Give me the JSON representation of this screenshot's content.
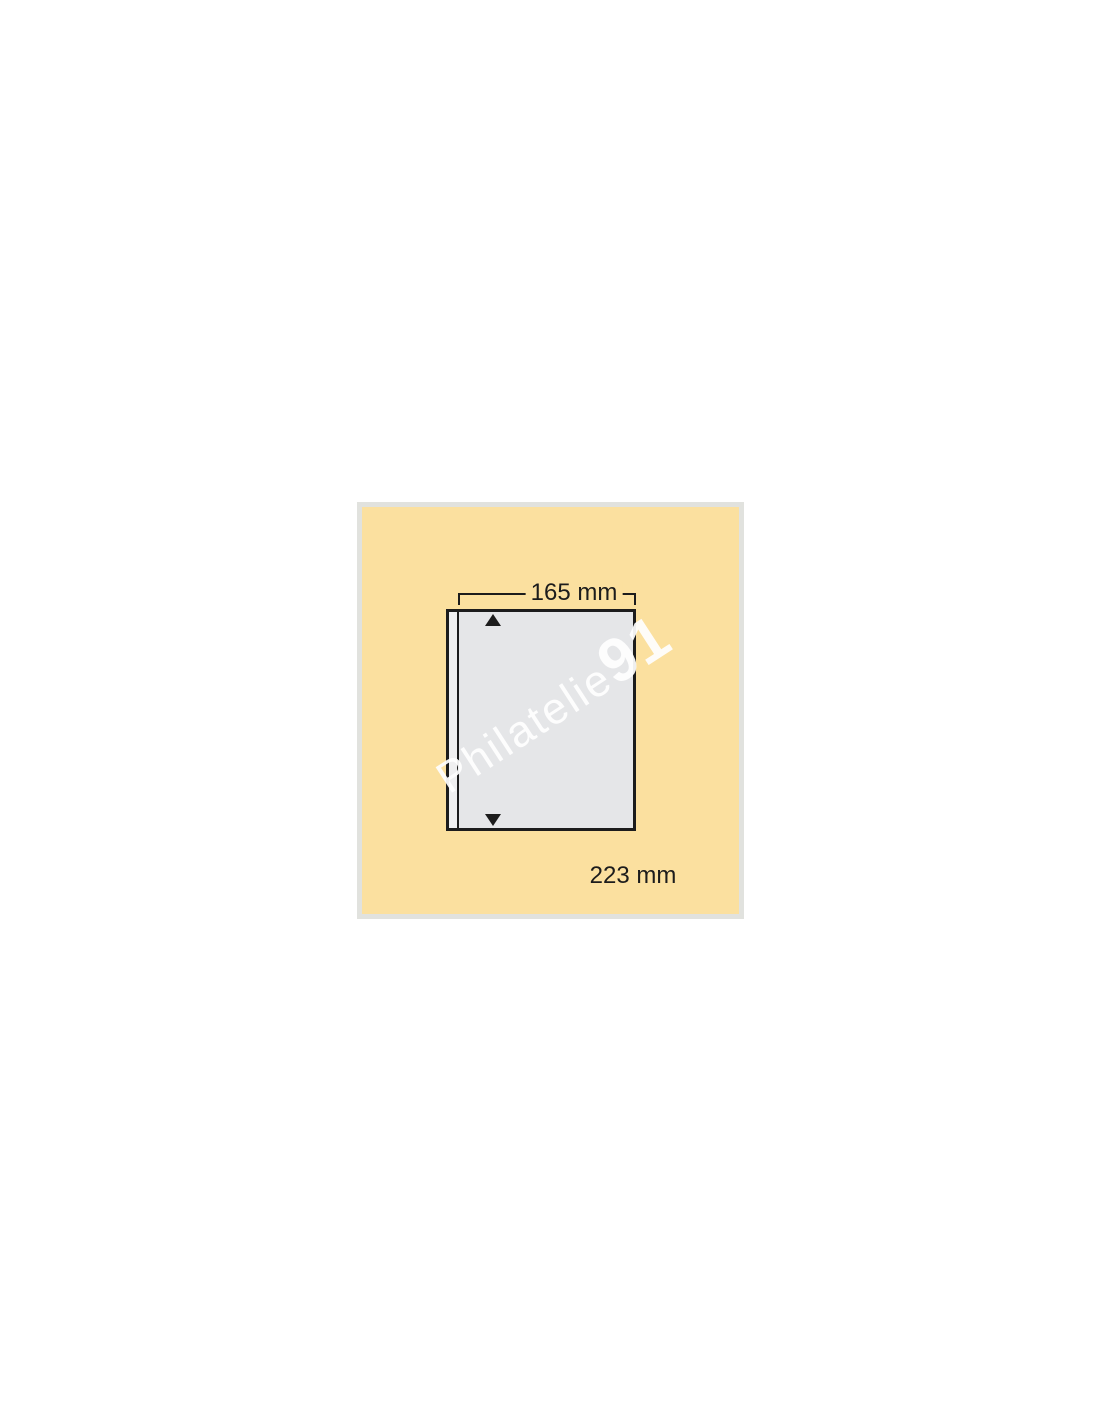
{
  "product_image": {
    "description_role": "album-page-diagram",
    "diagram": {
      "width_label": "165 mm",
      "height_label": "223 mm"
    },
    "watermark": {
      "text": "Philatelie",
      "suffix": "91"
    }
  },
  "colors": {
    "canvas-bg": "#ffffff",
    "frame": "#e1e2de",
    "yellow": "#fbe09f",
    "ink": "#1c1c1c",
    "pocket": "#e5e6e8",
    "strip": "#efeff0",
    "watermark": "#ffffff"
  }
}
